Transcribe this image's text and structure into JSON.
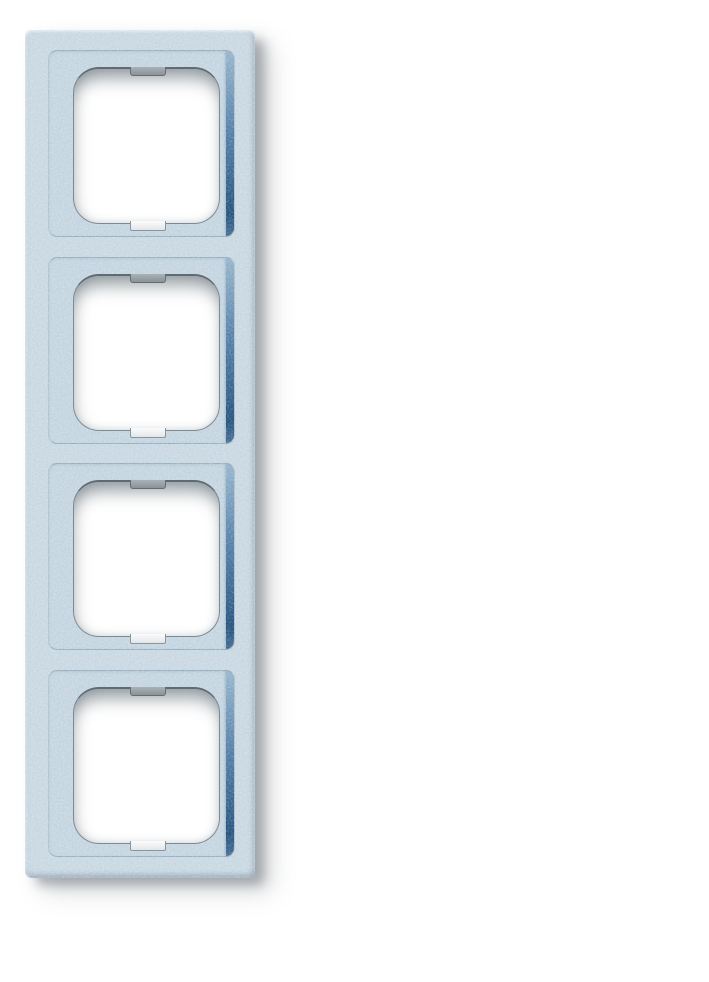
{
  "scene": {
    "description": "Product photograph of a vertical four-gang electrical switch cover frame with a textured light blue-silver (aluminium) finish, photographed on a plain white background with a soft drop shadow falling to the lower right",
    "object_name": "4-gang switch cover frame",
    "orientation": "vertical",
    "gang_count": 4,
    "finish": "speckled metallic, light blue-silver"
  },
  "frame": {
    "modules": [
      {
        "label": "module-1"
      },
      {
        "label": "module-2"
      },
      {
        "label": "module-3"
      },
      {
        "label": "module-4"
      }
    ]
  },
  "colors": {
    "page_bg": "#ffffff",
    "frame_base": "#ccdae4",
    "frame_highlight": "#eaf2f7",
    "frame_edge_dark": "#9db4c5",
    "plateau_fill": "#c7d7e2",
    "plateau_line": "#a2bacb",
    "recess_top": "#8fb0c9",
    "recess_mid": "#3f6f9c",
    "recess_deep": "#1b4a78",
    "opening_fill": "#ffffff",
    "opening_edge": "#7d8a93",
    "opening_edge_dark": "#5f6a72",
    "tab_fill": "#9aa4aa",
    "tab_edge": "#656d73",
    "drop_shadow": "rgba(104,112,117,0.5)",
    "drop_shadow_soft": "rgba(122,130,136,0.28)"
  }
}
